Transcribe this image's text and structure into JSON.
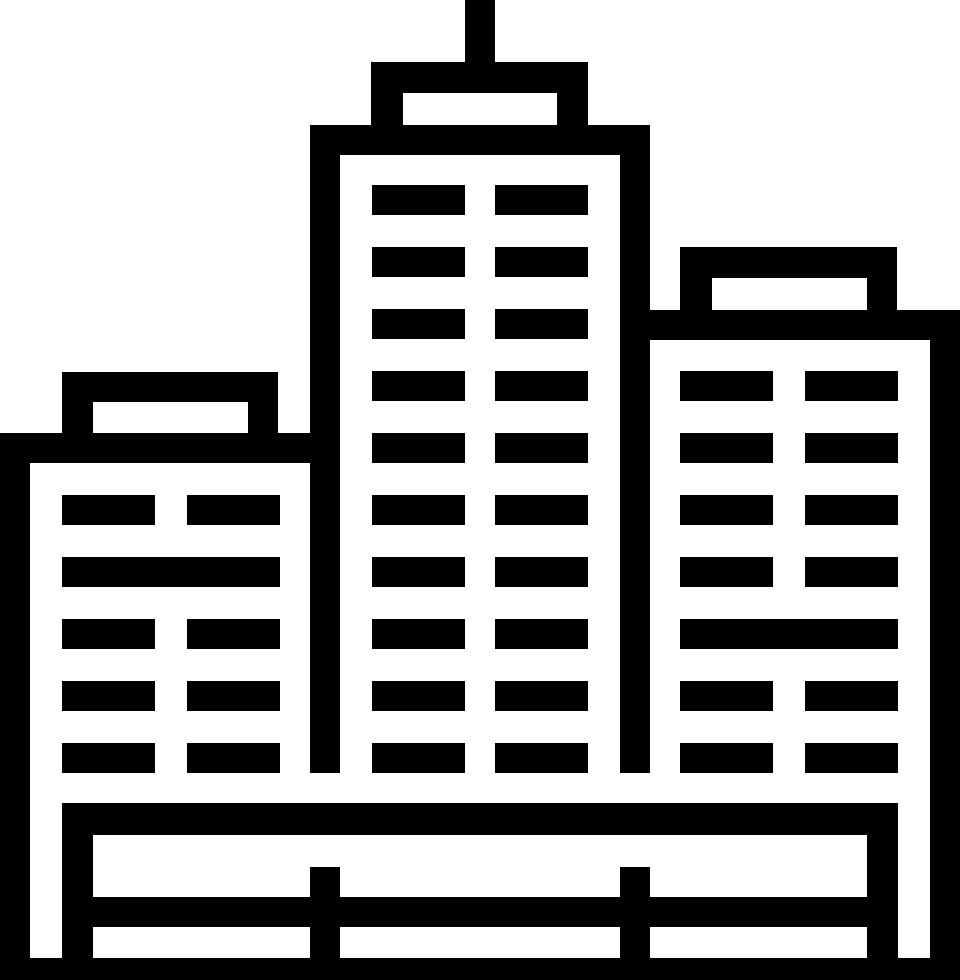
{
  "icon": {
    "name": "city-buildings-icon",
    "description": "cityscape pictogram with three buildings, antenna and fenced base",
    "foreground": "#000000",
    "background": "#ffffff",
    "canvas": {
      "width": 960,
      "height": 980
    },
    "rects": [
      {
        "name": "antenna-mast",
        "x": 465,
        "y": 0,
        "w": 30,
        "h": 62
      },
      {
        "name": "center-roof-cap-top",
        "x": 371,
        "y": 62,
        "w": 217,
        "h": 31
      },
      {
        "name": "center-roof-cap-left",
        "x": 371,
        "y": 93,
        "w": 32,
        "h": 32
      },
      {
        "name": "center-roof-cap-right",
        "x": 557,
        "y": 93,
        "w": 31,
        "h": 32
      },
      {
        "name": "center-tower-roof",
        "x": 310,
        "y": 125,
        "w": 340,
        "h": 30
      },
      {
        "name": "center-tower-left-wall",
        "x": 310,
        "y": 155,
        "w": 30,
        "h": 618
      },
      {
        "name": "center-tower-right-wall",
        "x": 620,
        "y": 155,
        "w": 30,
        "h": 618
      },
      {
        "name": "center-window-r1-c1",
        "x": 372,
        "y": 185,
        "w": 93,
        "h": 30
      },
      {
        "name": "center-window-r1-c2",
        "x": 495,
        "y": 185,
        "w": 93,
        "h": 30
      },
      {
        "name": "center-window-r2-c1",
        "x": 372,
        "y": 247,
        "w": 93,
        "h": 30
      },
      {
        "name": "center-window-r2-c2",
        "x": 495,
        "y": 247,
        "w": 93,
        "h": 30
      },
      {
        "name": "center-window-r3-c1",
        "x": 372,
        "y": 309,
        "w": 93,
        "h": 30
      },
      {
        "name": "center-window-r3-c2",
        "x": 495,
        "y": 309,
        "w": 93,
        "h": 30
      },
      {
        "name": "center-window-r4-c1",
        "x": 372,
        "y": 371,
        "w": 93,
        "h": 30
      },
      {
        "name": "center-window-r4-c2",
        "x": 495,
        "y": 371,
        "w": 93,
        "h": 30
      },
      {
        "name": "center-window-r5-c1",
        "x": 372,
        "y": 433,
        "w": 93,
        "h": 30
      },
      {
        "name": "center-window-r5-c2",
        "x": 495,
        "y": 433,
        "w": 93,
        "h": 30
      },
      {
        "name": "center-window-r6-c1",
        "x": 372,
        "y": 495,
        "w": 93,
        "h": 30
      },
      {
        "name": "center-window-r6-c2",
        "x": 495,
        "y": 495,
        "w": 93,
        "h": 30
      },
      {
        "name": "center-window-r7-c1",
        "x": 372,
        "y": 557,
        "w": 93,
        "h": 30
      },
      {
        "name": "center-window-r7-c2",
        "x": 495,
        "y": 557,
        "w": 93,
        "h": 30
      },
      {
        "name": "center-window-r8-c1",
        "x": 372,
        "y": 619,
        "w": 93,
        "h": 30
      },
      {
        "name": "center-window-r8-c2",
        "x": 495,
        "y": 619,
        "w": 93,
        "h": 30
      },
      {
        "name": "center-window-r9-c1",
        "x": 372,
        "y": 681,
        "w": 93,
        "h": 30
      },
      {
        "name": "center-window-r9-c2",
        "x": 495,
        "y": 681,
        "w": 93,
        "h": 30
      },
      {
        "name": "center-window-r10-c1",
        "x": 372,
        "y": 743,
        "w": 93,
        "h": 30
      },
      {
        "name": "center-window-r10-c2",
        "x": 495,
        "y": 743,
        "w": 93,
        "h": 30
      },
      {
        "name": "left-roof-cap-top",
        "x": 62,
        "y": 372,
        "w": 216,
        "h": 30
      },
      {
        "name": "left-roof-cap-left",
        "x": 62,
        "y": 402,
        "w": 31,
        "h": 31
      },
      {
        "name": "left-roof-cap-right",
        "x": 248,
        "y": 402,
        "w": 30,
        "h": 31
      },
      {
        "name": "left-building-roof",
        "x": 0,
        "y": 433,
        "w": 310,
        "h": 30
      },
      {
        "name": "left-building-left-wall",
        "x": 0,
        "y": 463,
        "w": 30,
        "h": 517
      },
      {
        "name": "left-window-r1-c1",
        "x": 62,
        "y": 495,
        "w": 93,
        "h": 30
      },
      {
        "name": "left-window-r1-c2",
        "x": 187,
        "y": 495,
        "w": 93,
        "h": 30
      },
      {
        "name": "left-window-r2-wide",
        "x": 62,
        "y": 557,
        "w": 218,
        "h": 30
      },
      {
        "name": "left-window-r3-c1",
        "x": 62,
        "y": 619,
        "w": 93,
        "h": 30
      },
      {
        "name": "left-window-r3-c2",
        "x": 187,
        "y": 619,
        "w": 93,
        "h": 30
      },
      {
        "name": "left-window-r4-c1",
        "x": 62,
        "y": 681,
        "w": 93,
        "h": 30
      },
      {
        "name": "left-window-r4-c2",
        "x": 187,
        "y": 681,
        "w": 93,
        "h": 30
      },
      {
        "name": "left-window-r5-c1",
        "x": 62,
        "y": 743,
        "w": 93,
        "h": 30
      },
      {
        "name": "left-window-r5-c2",
        "x": 187,
        "y": 743,
        "w": 93,
        "h": 30
      },
      {
        "name": "right-roof-cap-top",
        "x": 680,
        "y": 247,
        "w": 217,
        "h": 31
      },
      {
        "name": "right-roof-cap-left",
        "x": 680,
        "y": 278,
        "w": 32,
        "h": 32
      },
      {
        "name": "right-roof-cap-right",
        "x": 867,
        "y": 278,
        "w": 30,
        "h": 32
      },
      {
        "name": "right-building-roof",
        "x": 650,
        "y": 310,
        "w": 310,
        "h": 30
      },
      {
        "name": "right-building-right-wall",
        "x": 930,
        "y": 340,
        "w": 30,
        "h": 640
      },
      {
        "name": "right-window-r1-c1",
        "x": 680,
        "y": 371,
        "w": 93,
        "h": 30
      },
      {
        "name": "right-window-r1-c2",
        "x": 805,
        "y": 371,
        "w": 93,
        "h": 30
      },
      {
        "name": "right-window-r2-c1",
        "x": 680,
        "y": 433,
        "w": 93,
        "h": 30
      },
      {
        "name": "right-window-r2-c2",
        "x": 805,
        "y": 433,
        "w": 93,
        "h": 30
      },
      {
        "name": "right-window-r3-c1",
        "x": 680,
        "y": 495,
        "w": 93,
        "h": 30
      },
      {
        "name": "right-window-r3-c2",
        "x": 805,
        "y": 495,
        "w": 93,
        "h": 30
      },
      {
        "name": "right-window-r4-c1",
        "x": 680,
        "y": 557,
        "w": 93,
        "h": 30
      },
      {
        "name": "right-window-r4-c2",
        "x": 805,
        "y": 557,
        "w": 93,
        "h": 30
      },
      {
        "name": "right-window-r5-wide",
        "x": 680,
        "y": 619,
        "w": 218,
        "h": 30
      },
      {
        "name": "right-window-r6-c1",
        "x": 680,
        "y": 681,
        "w": 93,
        "h": 30
      },
      {
        "name": "right-window-r6-c2",
        "x": 805,
        "y": 681,
        "w": 93,
        "h": 30
      },
      {
        "name": "right-window-r7-c1",
        "x": 680,
        "y": 743,
        "w": 93,
        "h": 30
      },
      {
        "name": "right-window-r7-c2",
        "x": 805,
        "y": 743,
        "w": 93,
        "h": 30
      },
      {
        "name": "ground-platform-bar",
        "x": 62,
        "y": 803,
        "w": 836,
        "h": 32
      },
      {
        "name": "ground-left-post",
        "x": 62,
        "y": 835,
        "w": 31,
        "h": 123
      },
      {
        "name": "ground-right-post",
        "x": 867,
        "y": 835,
        "w": 31,
        "h": 123
      },
      {
        "name": "fence-rail",
        "x": 62,
        "y": 897,
        "w": 836,
        "h": 30
      },
      {
        "name": "fence-post-left",
        "x": 310,
        "y": 867,
        "w": 30,
        "h": 113
      },
      {
        "name": "fence-post-right",
        "x": 620,
        "y": 867,
        "w": 30,
        "h": 113
      },
      {
        "name": "ground-base-bar",
        "x": 0,
        "y": 958,
        "w": 960,
        "h": 22
      }
    ]
  }
}
